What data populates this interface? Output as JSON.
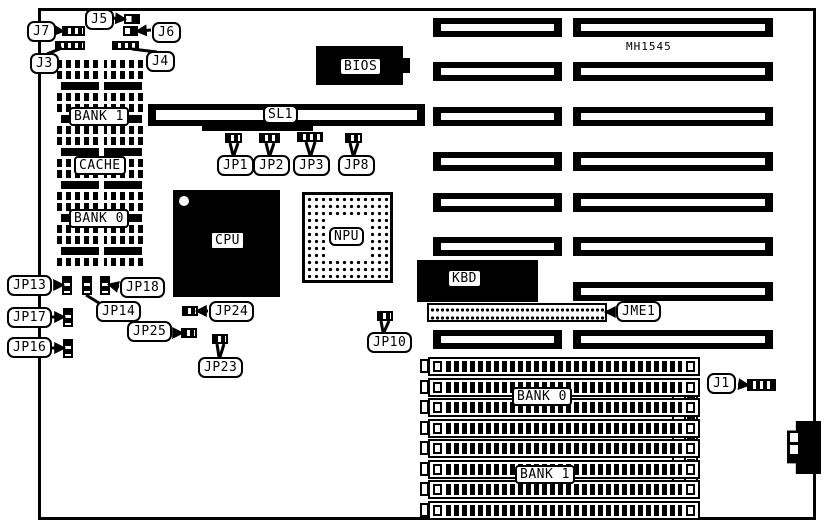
{
  "part_number": "MH1545",
  "connector_labels": {
    "j1": "J1",
    "j3": "J3",
    "j4": "J4",
    "j5": "J5",
    "j6": "J6",
    "j7": "J7",
    "jme1": "JME1"
  },
  "jumper_labels": {
    "jp1": "JP1",
    "jp2": "JP2",
    "jp3": "JP3",
    "jp8": "JP8",
    "jp10": "JP10",
    "jp13": "JP13",
    "jp14": "JP14",
    "jp16": "JP16",
    "jp17": "JP17",
    "jp18": "JP18",
    "jp23": "JP23",
    "jp24": "JP24",
    "jp25": "JP25"
  },
  "component_labels": {
    "bios": "BIOS",
    "cpu": "CPU",
    "npu": "NPU",
    "kbd": "KBD",
    "sl1": "SL1"
  },
  "memory_labels": {
    "dip_bank1": "BANK 1",
    "dip_cache": "CACHE",
    "dip_bank0": "BANK 0",
    "simm_bank0": "BANK 0",
    "simm_bank1": "BANK 1"
  },
  "counts": {
    "isa_slots_left_column": 7,
    "isa_slots_right_column": 8,
    "simm_sockets": 8,
    "dip_rows": 19
  },
  "colors": {
    "outline": "#000000",
    "fill": "#000000",
    "background": "#ffffff"
  }
}
